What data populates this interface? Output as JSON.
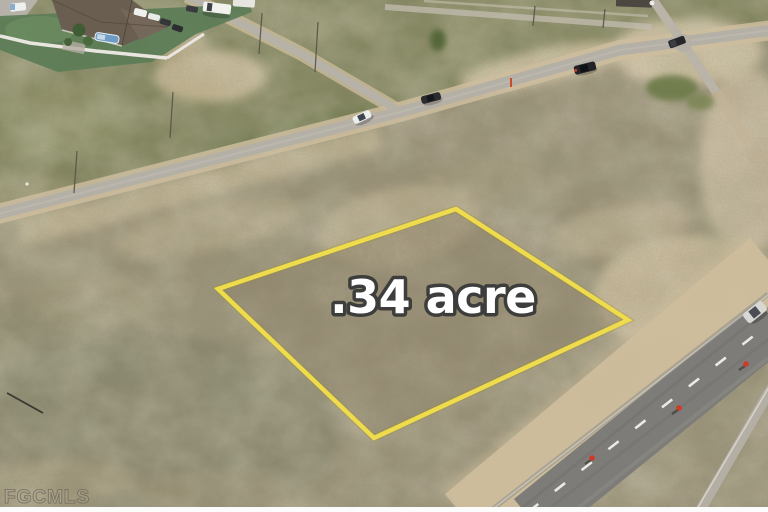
{
  "overlay": {
    "parcel_label": ".34 acre",
    "watermark": "FGCMLS",
    "colors": {
      "parcel_outline": "#eedc4c",
      "parcel_label_fill": "#ffffff"
    }
  }
}
